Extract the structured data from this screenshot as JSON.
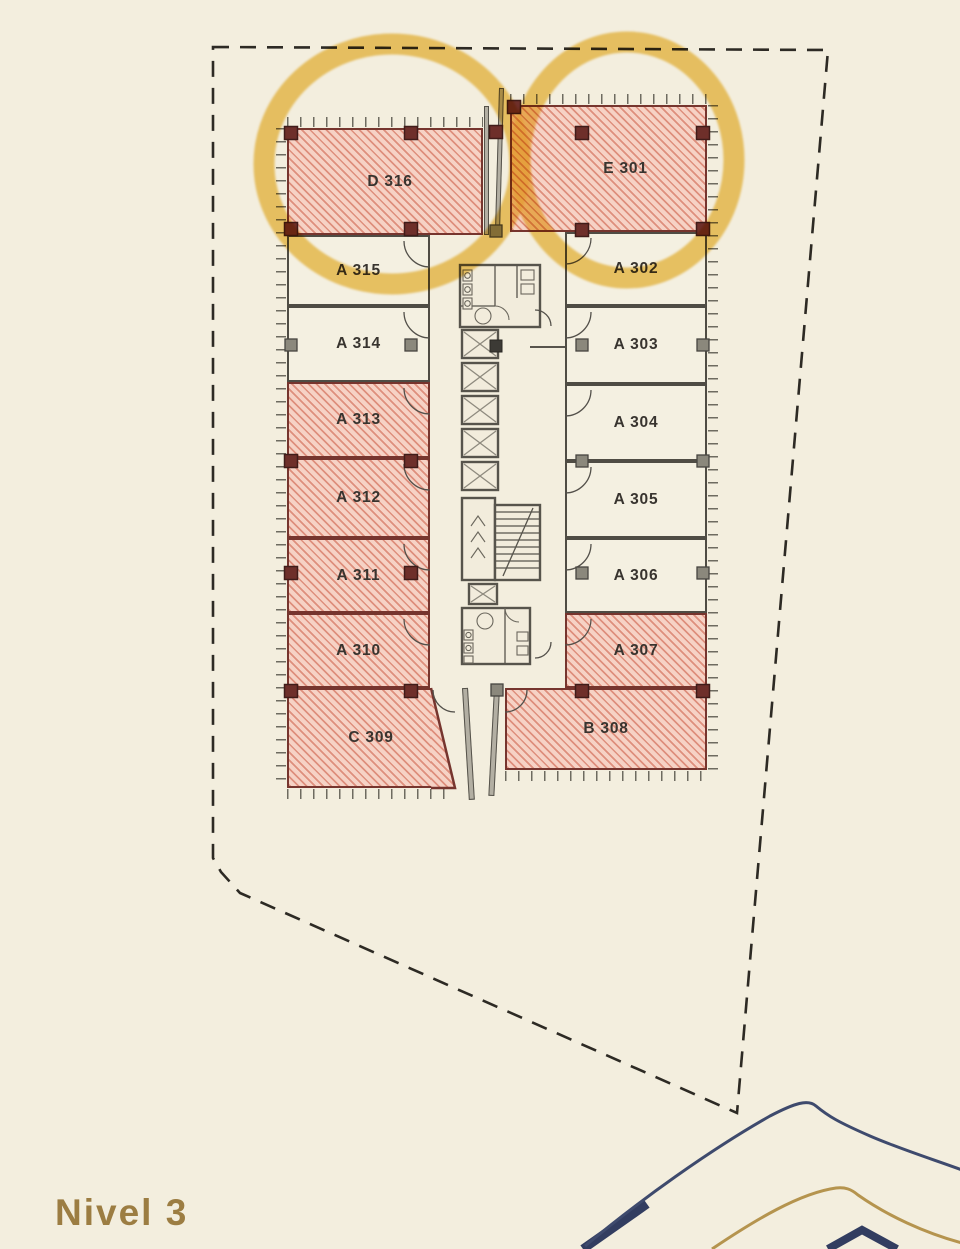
{
  "title": {
    "label": "Nivel 3"
  },
  "plan": {
    "units": {
      "d316": {
        "label": "D 316",
        "highlighted": true,
        "circled": true
      },
      "e301": {
        "label": "E 301",
        "highlighted": true,
        "circled": true
      },
      "a315": {
        "label": "A 315",
        "highlighted": false,
        "circled": false
      },
      "a302": {
        "label": "A 302",
        "highlighted": false,
        "circled": false
      },
      "a314": {
        "label": "A 314",
        "highlighted": false,
        "circled": false
      },
      "a303": {
        "label": "A 303",
        "highlighted": false,
        "circled": false
      },
      "a313": {
        "label": "A 313",
        "highlighted": true,
        "circled": false
      },
      "a304": {
        "label": "A 304",
        "highlighted": false,
        "circled": false
      },
      "a312": {
        "label": "A 312",
        "highlighted": true,
        "circled": false
      },
      "a305": {
        "label": "A 305",
        "highlighted": false,
        "circled": false
      },
      "a311": {
        "label": "A 311",
        "highlighted": true,
        "circled": false
      },
      "a306": {
        "label": "A 306",
        "highlighted": false,
        "circled": false
      },
      "a310": {
        "label": "A 310",
        "highlighted": true,
        "circled": false
      },
      "a307": {
        "label": "A 307",
        "highlighted": true,
        "circled": false
      },
      "c309": {
        "label": "C 309",
        "highlighted": true,
        "circled": false
      },
      "b308": {
        "label": "B 308",
        "highlighted": true,
        "circled": false
      }
    },
    "colors": {
      "highlight_fill": "#f6d2c5",
      "highlight_stripe": "#cb5842",
      "highlight_border": "#76352e",
      "circle_yellow": "#edbf4a",
      "background": "#f3eede"
    }
  },
  "decoration": {
    "navy": "#3e4a6d",
    "gold": "#b5944e",
    "title_color": "#9c7d42"
  }
}
